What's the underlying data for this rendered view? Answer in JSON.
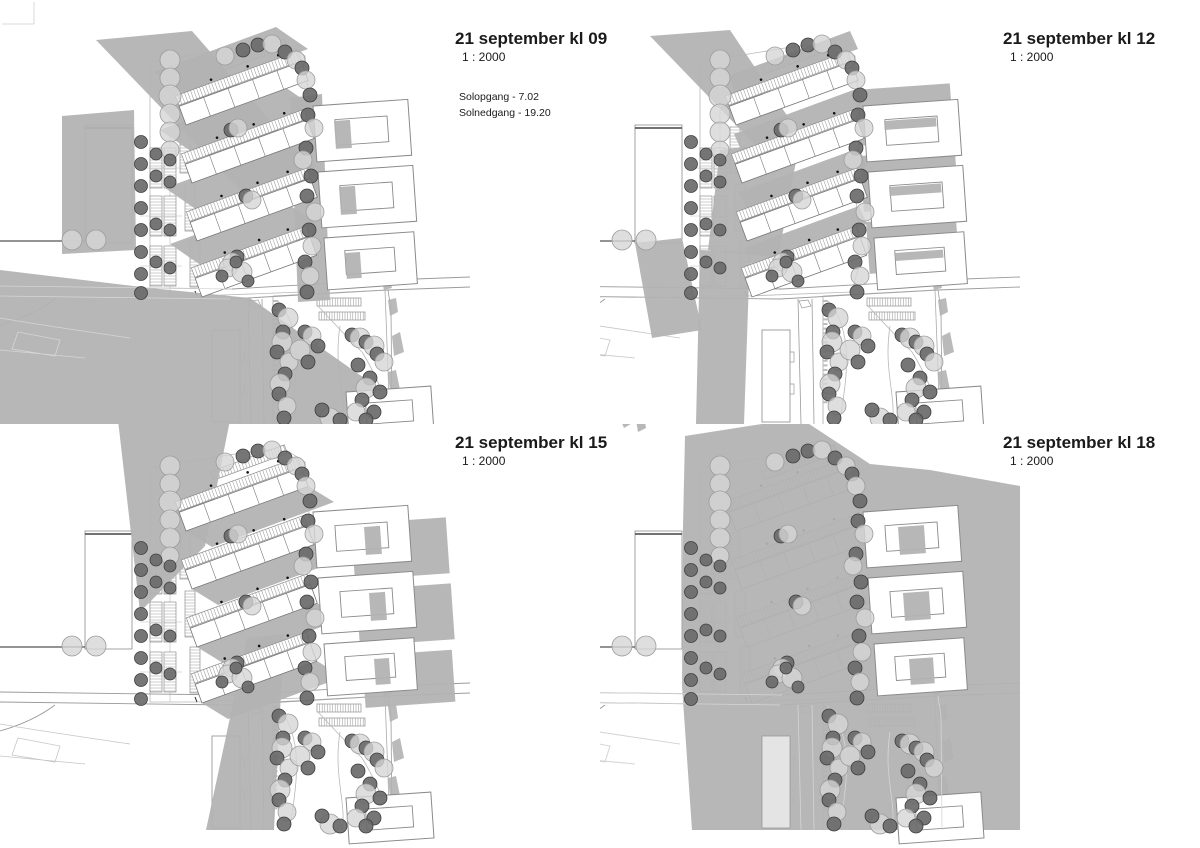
{
  "document": {
    "kind": "architectural shadow study sheet",
    "sheet_background": "#ffffff"
  },
  "panels": [
    {
      "id": "kl09",
      "title": "21 september kl 09",
      "scale": "1 : 2000",
      "sunrise": "Solopgang - 7.02",
      "sunset": "Solnedgang - 19.20"
    },
    {
      "id": "kl12",
      "title": "21 september kl 12",
      "scale": "1 : 2000"
    },
    {
      "id": "kl15",
      "title": "21 september kl 15",
      "scale": "1 : 2000"
    },
    {
      "id": "kl18",
      "title": "21 september kl 18",
      "scale": "1 : 2000"
    }
  ],
  "colors": {
    "shadow": "#b2b2b2",
    "tree_dark": "#6a6a6a",
    "tree_dark_stroke": "#3e3e3e",
    "tree_light": "#d6d6d6",
    "tree_light_stroke": "#9c9c9c",
    "line": "#9a9a9a",
    "line_light": "#c6c6c6",
    "line_faint": "#d6d6d6",
    "building_stroke": "#8a8a8a",
    "units_stroke": "#777777",
    "dark_edge": "#444444",
    "text": "#1a1a1a"
  }
}
